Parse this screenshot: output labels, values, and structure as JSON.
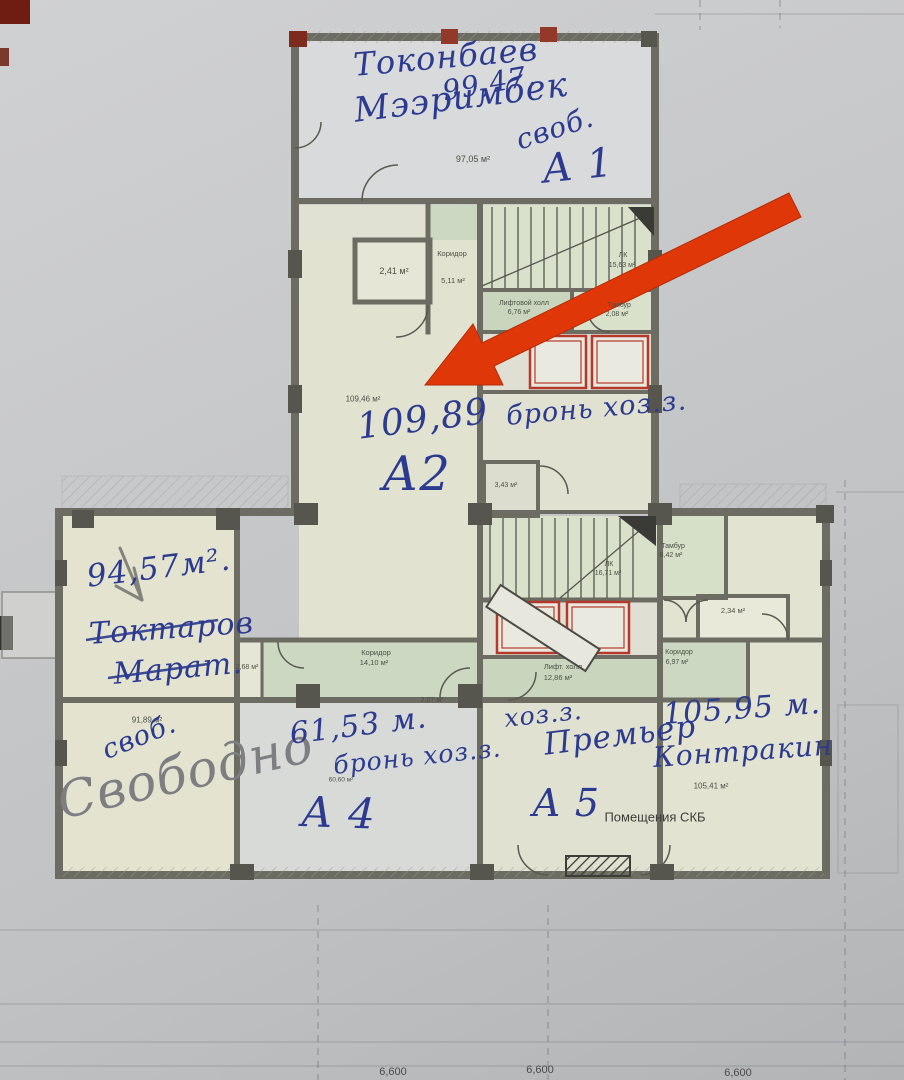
{
  "hw": {
    "a1_name1": "Токонбаев",
    "a1_name2": "Мээримбек",
    "a1_area": "99,47.",
    "a1_free": "своб.",
    "a1": "А 1",
    "a2_area": "109,89",
    "a2": "А2",
    "a2_note": "бронь хоз.з.",
    "left_area": "94,57м².",
    "left_name1": "Токтаров",
    "left_name2": "Марат.",
    "free_short": "своб.",
    "free_big": "Свободно",
    "a4_area": "61,53 м.",
    "a4_note": "бронь хоз.з.",
    "a4": "А 4",
    "a5_note": "хоз.з.",
    "a5_name": "Премьер",
    "a5": "А 5",
    "right_area": "105,95 м.",
    "right_name": "Контракин"
  },
  "pr": {
    "top_room": "97,05 м²",
    "r241": "2,41 м²",
    "corr_top": "Коридор",
    "corr_top_a": "5,11 м²",
    "lk_top": "ЛК",
    "lk_top_a": "15,63 м²",
    "lift_top": "Лифтовой холл",
    "lift_top_a": "6,76 м²",
    "tamb_top": "Тамбур",
    "tamb_top_a": "2,08 м²",
    "a2_room": "109,46 м²",
    "wc": "3,43 м²",
    "lk_low": "ЛК",
    "lk_low_a": "16,71 м²",
    "lift_low": "Лифт. холл",
    "lift_low_a": "12,86 м²",
    "tamb_low": "Тамбур",
    "tamb_low_a": "8,42 м²",
    "r234": "2,34 м²",
    "corr_right": "Коридор",
    "corr_right_a": "6,97 м²",
    "corr_left": "Коридор",
    "corr_left_a": "14,10 м²",
    "r268": "2,68 м²",
    "r9189": "91,89 м²",
    "a4_room": "60,60 м²",
    "r207": "2,07 м²",
    "r10541": "105,41 м²",
    "skb": "Помещения СКБ"
  },
  "dims": {
    "d1": "6,600",
    "d2": "6,600",
    "d3": "6,600"
  },
  "colors": {
    "arrow_red": "#e03708",
    "ink_blue": "#2c3a90",
    "pencil_gray": "#7b7b80"
  }
}
